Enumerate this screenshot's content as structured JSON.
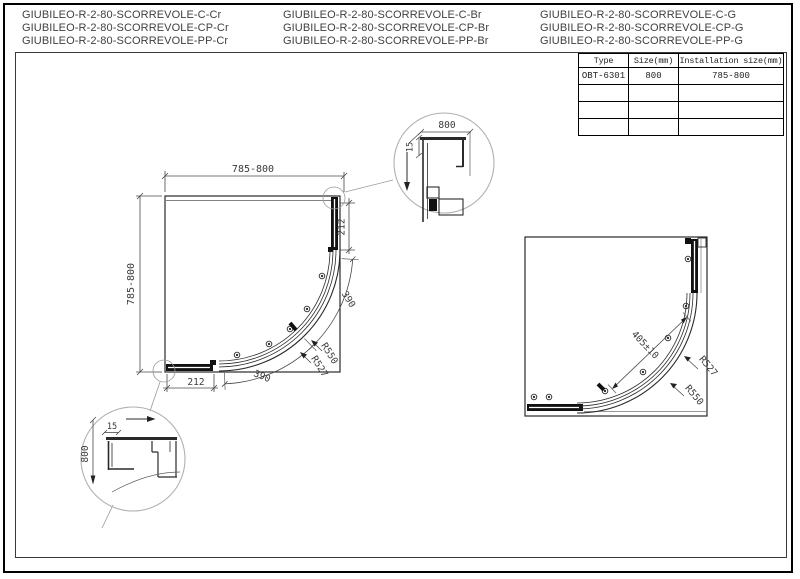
{
  "product_names": {
    "col1": [
      "GIUBILEO-R-2-80-SCORREVOLE-C-Cr",
      "GIUBILEO-R-2-80-SCORREVOLE-CP-Cr",
      "GIUBILEO-R-2-80-SCORREVOLE-PP-Cr"
    ],
    "col2": [
      "GIUBILEO-R-2-80-SCORREVOLE-C-Br",
      "GIUBILEO-R-2-80-SCORREVOLE-CP-Br",
      "GIUBILEO-R-2-80-SCORREVOLE-PP-Br"
    ],
    "col3": [
      "GIUBILEO-R-2-80-SCORREVOLE-C-G",
      "GIUBILEO-R-2-80-SCORREVOLE-CP-G",
      "GIUBILEO-R-2-80-SCORREVOLE-PP-G"
    ]
  },
  "spec_table": {
    "headers": [
      "Type",
      "Size(mm)",
      "Installation size(mm)"
    ],
    "rows": [
      [
        "OBT-6301",
        "800",
        "785-800"
      ],
      [
        "",
        "",
        ""
      ],
      [
        "",
        "",
        ""
      ],
      [
        "",
        "",
        ""
      ]
    ]
  },
  "left_drawing": {
    "width_dim": "785-800",
    "height_dim": "785-800",
    "side_segment_dim": "212",
    "bottom_segment_dim": "212",
    "arc_dim_upper": "390",
    "arc_dim_lower": "390",
    "radius_outer": "R550",
    "radius_inner": "R527"
  },
  "right_drawing": {
    "door_dim": "405±10",
    "radius_inner": "R527",
    "radius_outer": "R550"
  },
  "detail_top": {
    "width_dim": "800",
    "thickness_dim": "15"
  },
  "detail_bottom": {
    "thickness_dim": "15",
    "height_dim": "800"
  },
  "colors": {
    "drawing_line": "#2a2a2a",
    "dimension_line": "#4a4a4a",
    "text": "#3a3a3a",
    "profile_fill": "#111111",
    "detail_circle": "#b0b0b0"
  }
}
